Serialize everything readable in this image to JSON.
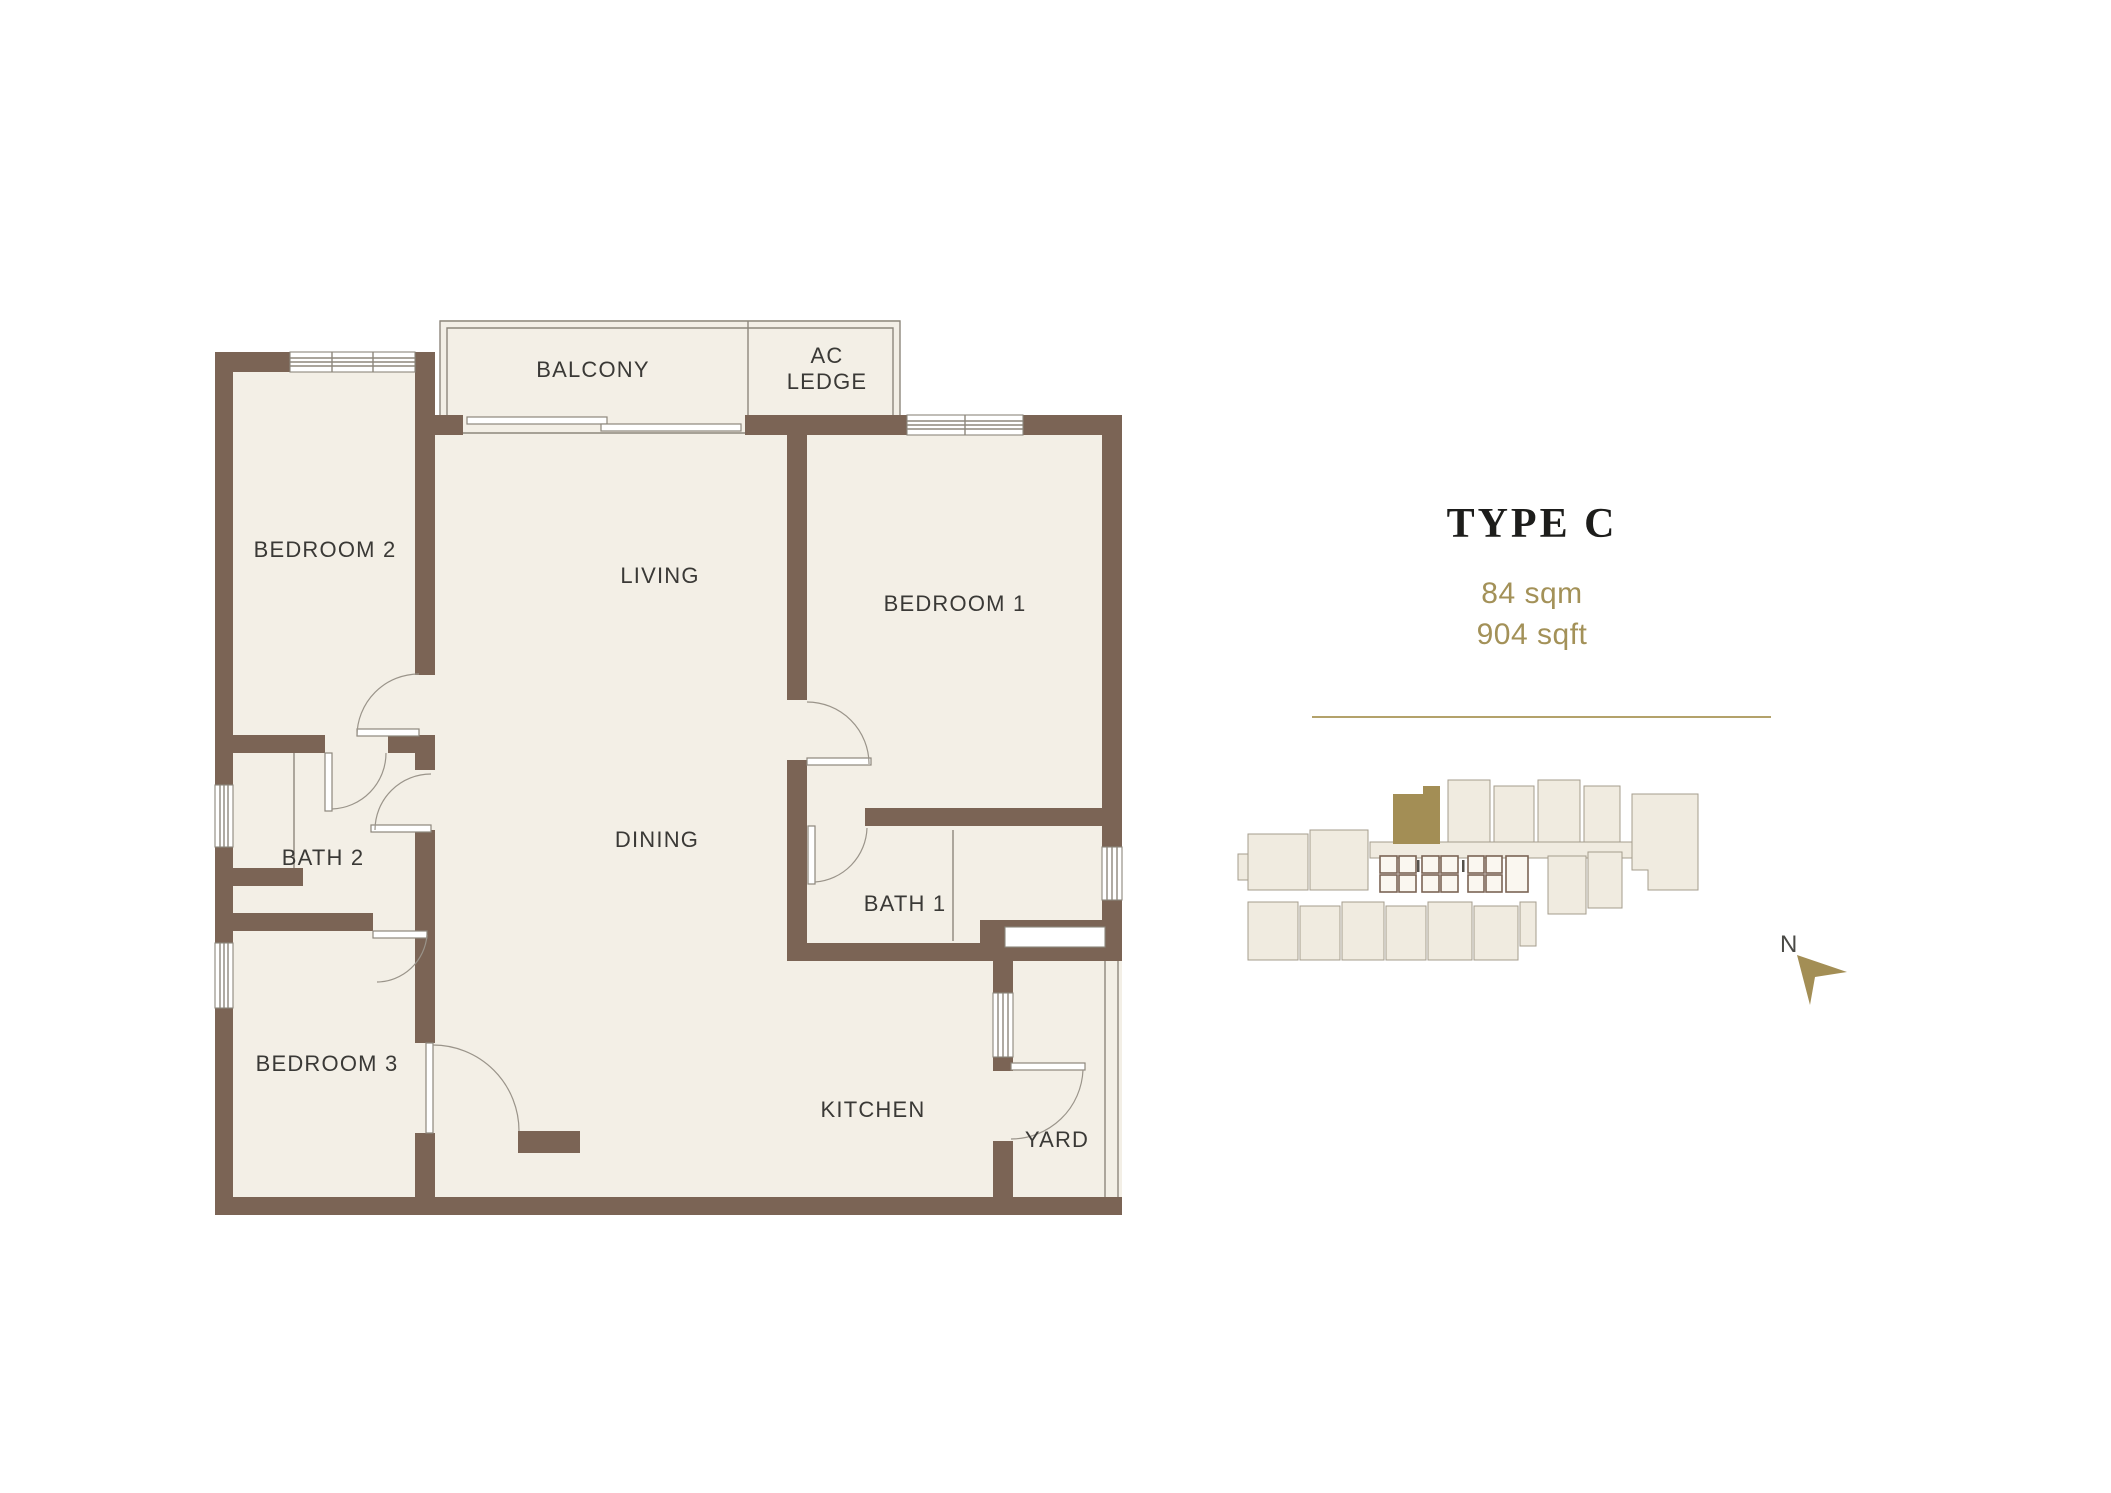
{
  "floor_plan": {
    "labels": {
      "bedroom2": "BEDROOM 2",
      "balcony": "BALCONY",
      "ac_ledge_line1": "AC",
      "ac_ledge_line2": "LEDGE",
      "living": "LIVING",
      "bedroom1": "BEDROOM 1",
      "bath2": "BATH 2",
      "dining": "DINING",
      "bath1": "BATH 1",
      "bedroom3": "BEDROOM 3",
      "kitchen": "KITCHEN",
      "yard": "YARD"
    }
  },
  "info_panel": {
    "title": "TYPE C",
    "area_sqm": "84 sqm",
    "area_sqft": "904 sqft"
  },
  "key_plan": {
    "north_label": "N"
  },
  "colors": {
    "wall": "#7b6455",
    "floor": "#f3efe6",
    "line": "#8d877c",
    "accent": "#a39158",
    "title": "#1d1d1b",
    "label": "#3a3936",
    "kpfill": "#f0ebe0",
    "kpstroke": "#a59c8d",
    "highlight": "#a38e55",
    "divider": "#b3a26b"
  }
}
